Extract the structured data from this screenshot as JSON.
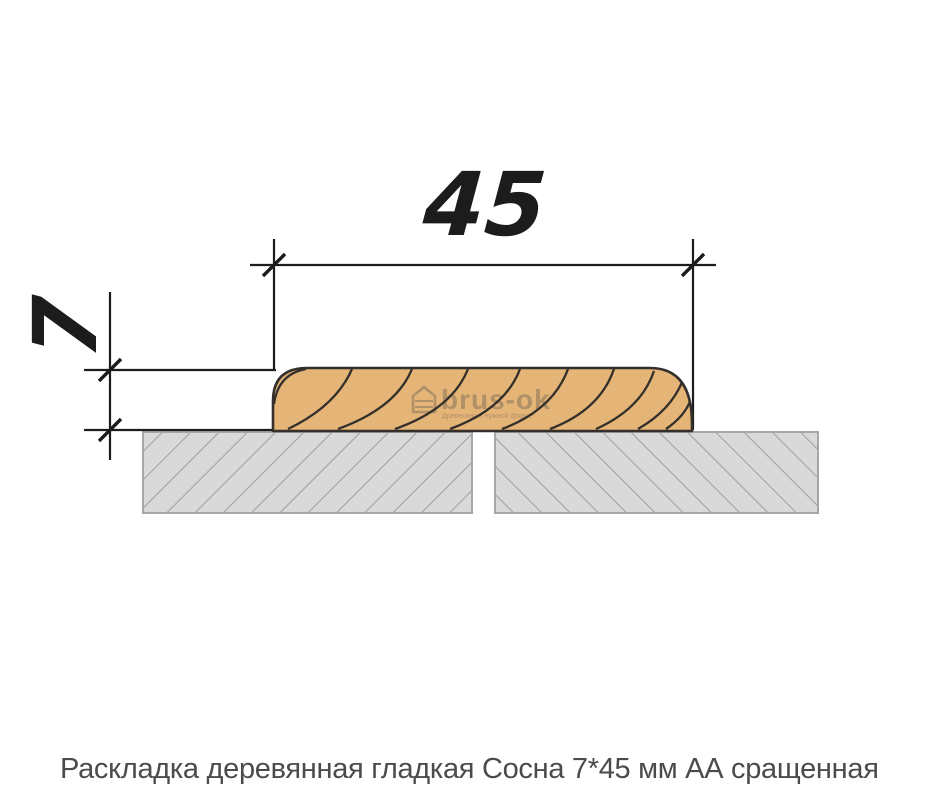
{
  "diagram": {
    "type": "profile-cross-section",
    "width_label": "45",
    "height_label": "7"
  },
  "watermark": {
    "name": "brus-ok",
    "tagline": "Древесина в нужной форме"
  },
  "caption": "Раскладка деревянная гладкая Сосна 7*45 мм АА сращенная",
  "colors": {
    "wood_fill": "#e5b477",
    "wood_outline": "#332f2b",
    "panel_fill": "#d9d9d9",
    "panel_hatch": "#9f9f9f",
    "panel_border": "#a7a7a7",
    "dimension_line": "#1c1c1c",
    "caption_text": "#4b4b4b",
    "background": "#ffffff"
  }
}
